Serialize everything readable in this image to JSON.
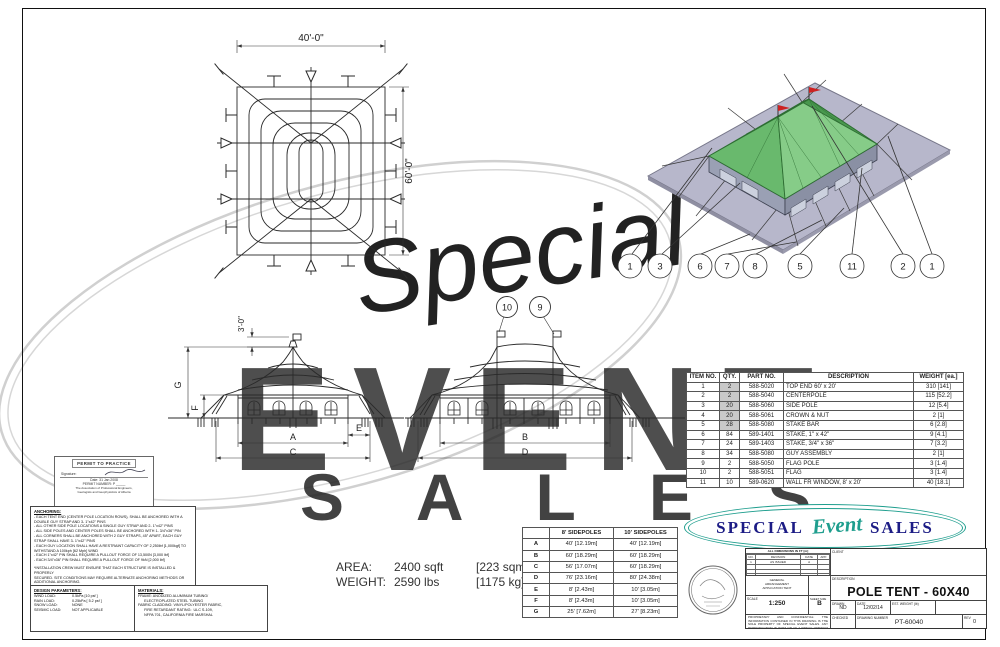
{
  "plan_view": {
    "width_dim": "40'-0\"",
    "height_dim": "60'-0\""
  },
  "end_elevation": {
    "flag_dim": "3'-0\"",
    "dims": {
      "g": "G",
      "f": "F",
      "a": "A",
      "e": "E",
      "c": "C"
    }
  },
  "side_elevation": {
    "dims": {
      "b": "B",
      "d": "D"
    },
    "callouts": {
      "flag": "10",
      "pole": "9"
    }
  },
  "iso_view": {
    "callouts": [
      "1",
      "3",
      "6",
      "7",
      "8",
      "5",
      "11",
      "2",
      "1"
    ]
  },
  "parts_table": {
    "headers": [
      "ITEM NO.",
      "QTY.",
      "PART NO.",
      "DESCRIPTION",
      "WEIGHT [ea.]"
    ],
    "rows": [
      [
        "1",
        "2",
        "588-5020",
        "TOP END 60' x 20'",
        "310 [141]"
      ],
      [
        "2",
        "2",
        "588-5040",
        "CENTERPOLE",
        "115 [52.2]"
      ],
      [
        "3",
        "20",
        "588-5060",
        "SIDE POLE",
        "12 [5.4]"
      ],
      [
        "4",
        "20",
        "588-5061",
        "CROWN & NUT",
        "2 [1]"
      ],
      [
        "5",
        "28",
        "588-5080",
        "STAKE BAR",
        "6 [2.8]"
      ],
      [
        "6",
        "84",
        "589-1401",
        "STAKE, 1\" x 42\"",
        "9 [4.1]"
      ],
      [
        "7",
        "24",
        "589-1403",
        "STAKE, 3/4\" x 36\"",
        "7 [3.2]"
      ],
      [
        "8",
        "34",
        "588-5080",
        "GUY ASSEMBLY",
        "2 [1]"
      ],
      [
        "9",
        "2",
        "588-5050",
        "FLAG POLE",
        "3 [1.4]"
      ],
      [
        "10",
        "2",
        "588-5051",
        "FLAG",
        "3 [1.4]"
      ],
      [
        "11",
        "10",
        "589-0620",
        "WALL FR WINDOW, 8' x 20'",
        "40 [18.1]"
      ]
    ]
  },
  "dims_table": {
    "headers": [
      "",
      "8' SIDEPOLES",
      "10' SIDEPOLES"
    ],
    "rows": [
      [
        "A",
        "40' [12.19m]",
        "40' [12.19m]"
      ],
      [
        "B",
        "60' [18.29m]",
        "60' [18.29m]"
      ],
      [
        "C",
        "56' [17.07m]",
        "60' [18.29m]"
      ],
      [
        "D",
        "76' [23.16m]",
        "80' [24.38m]"
      ],
      [
        "E",
        "8' [2.43m]",
        "10' [3.05m]"
      ],
      [
        "F",
        "8' [2.43m]",
        "10' [3.05m]"
      ],
      [
        "G",
        "25' [7.62m]",
        "27' [8.23m]"
      ]
    ]
  },
  "area_weight": {
    "area_label": "AREA:",
    "area_value": "2400 sqft",
    "area_metric": "[223 sqm]",
    "weight_label": "WEIGHT:",
    "weight_value": "2590 lbs",
    "weight_metric": "[1175 kg]"
  },
  "anchoring": {
    "title": "ANCHORING:",
    "lines": [
      "- EACH TENT END (CENTER POLE LOCATION ROWS), SHALL BE ANCHORED WITH A DOUBLE GUY STRAP AND 3- 1\"x42\" PINS",
      "- ALL OTHER SIDE POLE LOCATIONS A SINGLE GUY STRAP AND 2- 1\"x42\" PINS",
      "- ALL SIDE POLES AND CENTER POLES SHALL BE ANCHORED WITH 1- 3/4\"x36\" PIN",
      "- ALL CORNERS SHALL BE ANCHORED WITH 2 GUY STRAPS, 45° APART, EACH GUY STRAP SHALL HAVE 3- 1\"x42\" PINS",
      "- EACH GUY LOCATION SHALL HAVE A RESTRAINT CAPACITY OF 2,250lbf [1,000kgf] TO WITHSTAND A 100kph [62 Mph] WIND",
      "- EACH 1\"x42\" PIN SHALL REQUIRE A PULLOUT FORCE OF 13,500N [3,000 lbf]",
      "- EACH 3/4\"x36\" PIN SHALL REQUIRE A PULLOUT FORCE OF 9kN [2,000 lbf]"
    ],
    "footnote_lines": [
      "*INSTALLATION CREW MUST ENSURE THAT EACH STRUCTURE IS INSTALLED & PROPERLY",
      "SECURED.  SITE CONDITIONS MAY REQUIRE ALTERNATE ANCHORING METHODS OR",
      "ADDITIONAL ANCHORING."
    ]
  },
  "design_parameters": {
    "title": "DESIGN PARAMETERS:",
    "rows": [
      [
        "WIND LOAD:",
        "0.5kPa [10 psf ]"
      ],
      [
        "RAIN LOAD:",
        "0.25kPa [ 5.2 psf ]"
      ],
      [
        "SNOW LOAD:",
        "NONE"
      ],
      [
        "SEISMIC LOAD:",
        "NOT APPLICABLE"
      ]
    ]
  },
  "materials": {
    "title": "MATERIALS:",
    "lines": [
      "FRAME: ANODIZED ALUMINUM TUBING/",
      "      ELECTROPLATED STEEL TUBING",
      "FABRIC CLADDING: VINYL/POLYESTER FABRIC,",
      "      FIRE RETARDANT RATING:  ULC S-109,",
      "      NFPA 701, CALIFORNIA FIRE MARSHAL"
    ]
  },
  "permit_stamp": {
    "title": "PERMIT TO PRACTICE",
    "signature_label": "Signature:",
    "date_line": "Date:   31 Jan 2008",
    "permit_line": "PERMIT NUMBER:  P _____",
    "assoc_lines": [
      "The Association of Professional Engineers,",
      "Geologists and Geophysicists of Alberta"
    ]
  },
  "logo": {
    "word1": "SPECIAL",
    "word2": "Event",
    "word3": "SALES"
  },
  "title_block": {
    "rev_table_title": "ALL DIMENSIONS IN FT [m]",
    "rev_headers": [
      "NO.",
      "REVISION",
      "DATE",
      "APP."
    ],
    "rev_rows": [
      [
        "1",
        "AS ISSUED",
        "A",
        ""
      ],
      [
        "",
        "",
        "",
        ""
      ],
      [
        "",
        "",
        "",
        ""
      ],
      [
        "",
        "",
        "",
        ""
      ]
    ],
    "note_lines": [
      "GENERAL",
      "ARRANGEMENT",
      "APPLICATION TENT"
    ],
    "scale_label": "SCALE",
    "scale_value": "1:250",
    "sheet_size_label": "SHEET SIZE",
    "sheet_size_value": "B",
    "client_label": "CLIENT",
    "description_label": "DESCRIPTION",
    "description_value": "POLE TENT - 60X40",
    "drawn_label": "DRAWN",
    "drawn_value": "ND",
    "date_label": "DATE",
    "date_value": "12/02/14",
    "est_weight_label": "EST. WEIGHT (lb)",
    "checked_label": "CHECKED",
    "drawing_number_label": "DRAWING NUMBER",
    "drawing_number_value": "PT-60040",
    "rev_label": "REV",
    "rev_value": "0",
    "disclaimer": "PROPRIETARY AND CONFIDENTIAL: THE INFORMATION CONTAINED IN THIS DRAWING IS THE SOLE PROPERTY OF SPECIAL EVENT SALES. ANY REPRODUCTION IN PART OR AS A WHOLE WITHOUT THE WRITTEN PERMISSION OF SPECIAL EVENT SALES IS PROHIBITED."
  },
  "watermark": {
    "script": "Special",
    "word": "EVENT",
    "word2": "S A L E S"
  },
  "colors": {
    "roof_light": "#86cc88",
    "roof_mid": "#69b96d",
    "roof_dark": "#49984e",
    "roof_back": "#5aa75e",
    "ground": "#b7b7cb",
    "wall_light": "#9aa0b4",
    "wall_dark": "#8a90a4",
    "logo_navy": "#1c1c85",
    "logo_teal": "#1f9e8e",
    "qty_shade": "#c9c9c9",
    "flag_red": "#cc2222"
  }
}
